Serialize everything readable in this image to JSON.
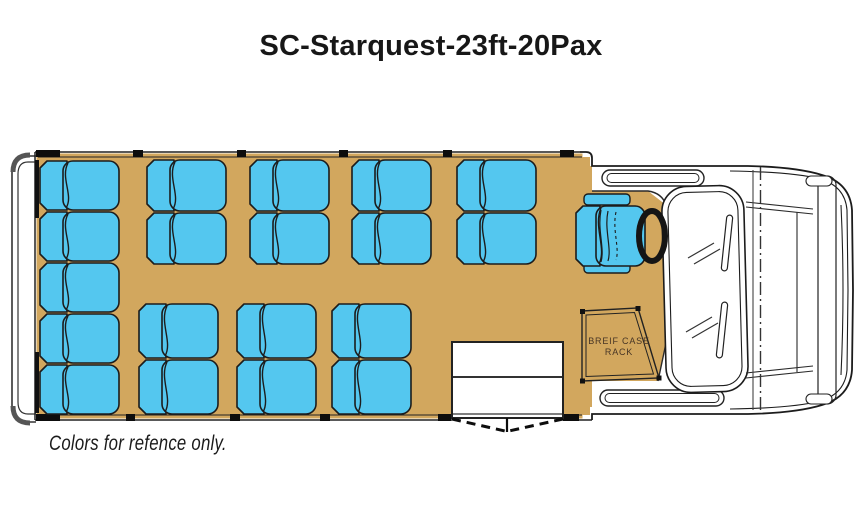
{
  "title": "SC-Starquest-23ft-20Pax",
  "footnote": "Colors for refence only.",
  "floorplan": {
    "briefcase_rack": {
      "line1": "BREIF CASE",
      "line2": "RACK"
    },
    "colors": {
      "seat_fill": "#54C7EF",
      "floor_fill": "#D2A75E",
      "outline": "#1c1c1c"
    },
    "seat_count_total": 20,
    "seats": [
      {
        "kind": "bench",
        "x": 38,
        "y": 160,
        "w": 82,
        "h": 51
      },
      {
        "kind": "bench",
        "x": 38,
        "y": 211,
        "w": 82,
        "h": 51
      },
      {
        "kind": "bench",
        "x": 38,
        "y": 262,
        "w": 82,
        "h": 51
      },
      {
        "kind": "bench",
        "x": 38,
        "y": 313,
        "w": 82,
        "h": 51
      },
      {
        "kind": "bench",
        "x": 38,
        "y": 364,
        "w": 82,
        "h": 51
      },
      {
        "kind": "pax",
        "x": 145,
        "y": 159,
        "w": 82,
        "h": 53
      },
      {
        "kind": "pax",
        "x": 145,
        "y": 212,
        "w": 82,
        "h": 53
      },
      {
        "kind": "pax",
        "x": 248,
        "y": 159,
        "w": 82,
        "h": 53
      },
      {
        "kind": "pax",
        "x": 248,
        "y": 212,
        "w": 82,
        "h": 53
      },
      {
        "kind": "pax",
        "x": 350,
        "y": 159,
        "w": 82,
        "h": 53
      },
      {
        "kind": "pax",
        "x": 350,
        "y": 212,
        "w": 82,
        "h": 53
      },
      {
        "kind": "pax",
        "x": 455,
        "y": 159,
        "w": 82,
        "h": 53
      },
      {
        "kind": "pax",
        "x": 455,
        "y": 212,
        "w": 82,
        "h": 53
      },
      {
        "kind": "pax",
        "x": 137,
        "y": 303,
        "w": 82,
        "h": 56
      },
      {
        "kind": "pax",
        "x": 137,
        "y": 359,
        "w": 82,
        "h": 56
      },
      {
        "kind": "pax",
        "x": 235,
        "y": 303,
        "w": 82,
        "h": 56
      },
      {
        "kind": "pax",
        "x": 235,
        "y": 359,
        "w": 82,
        "h": 56
      },
      {
        "kind": "pax",
        "x": 330,
        "y": 303,
        "w": 82,
        "h": 56
      },
      {
        "kind": "pax",
        "x": 330,
        "y": 359,
        "w": 82,
        "h": 56
      },
      {
        "kind": "driver",
        "x": 574,
        "y": 205,
        "w": 72,
        "h": 62
      }
    ]
  }
}
